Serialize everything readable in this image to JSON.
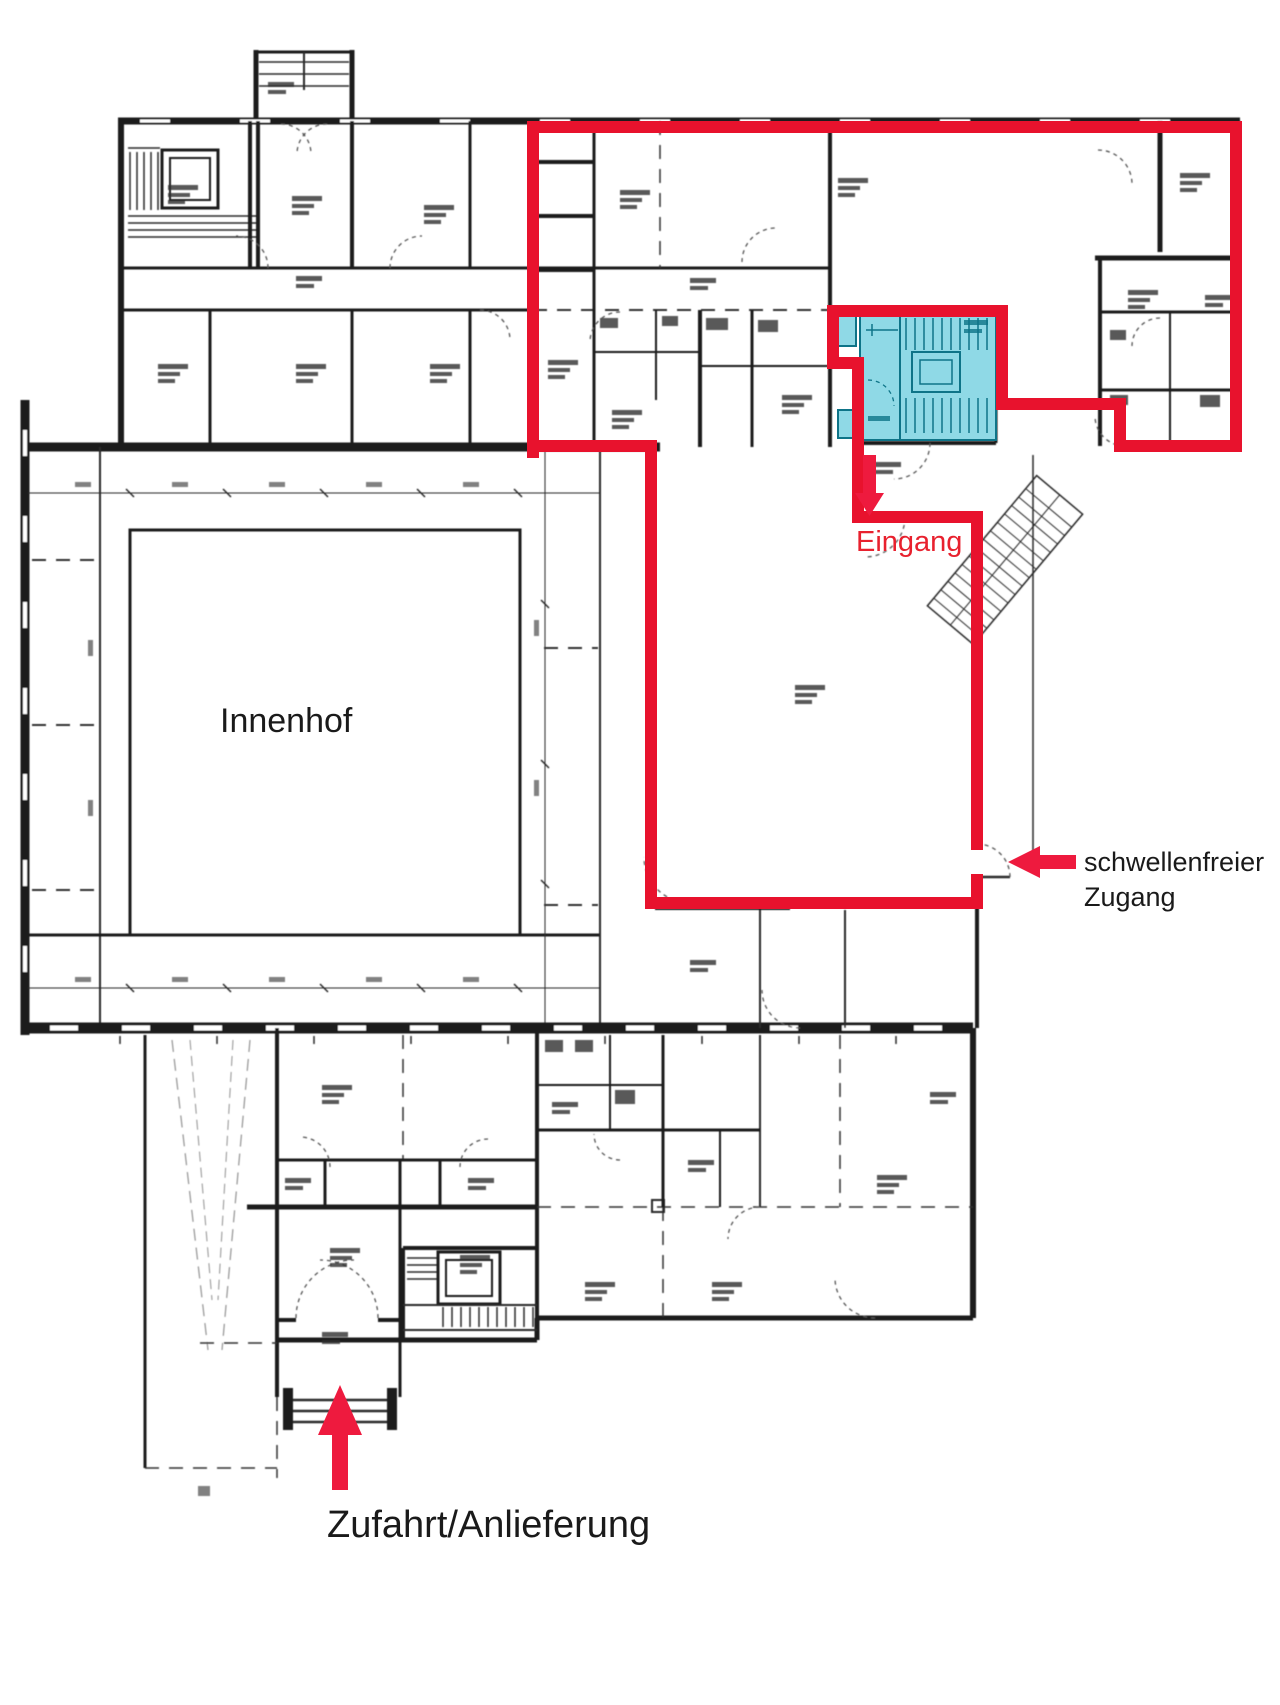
{
  "annotations": {
    "courtyard": {
      "label": "Innenhof"
    },
    "entrance": {
      "label": "Eingang",
      "arrow": "arrow-down-icon"
    },
    "threshold_access": {
      "line1": "schwellenfreier",
      "line2": "Zugang",
      "arrow": "arrow-left-icon"
    },
    "delivery": {
      "label": "Zufahrt/Anlieferung",
      "arrow": "arrow-up-icon"
    }
  },
  "colors": {
    "boundary_red": "#e8122d",
    "arrow_red": "#ee1a3e",
    "entrance_text_red": "#e8212e",
    "annotation_black": "#1a1a1a",
    "highlight_fill": "#8fd9e6",
    "highlight_stroke": "#0e7488",
    "background": "#ffffff"
  }
}
